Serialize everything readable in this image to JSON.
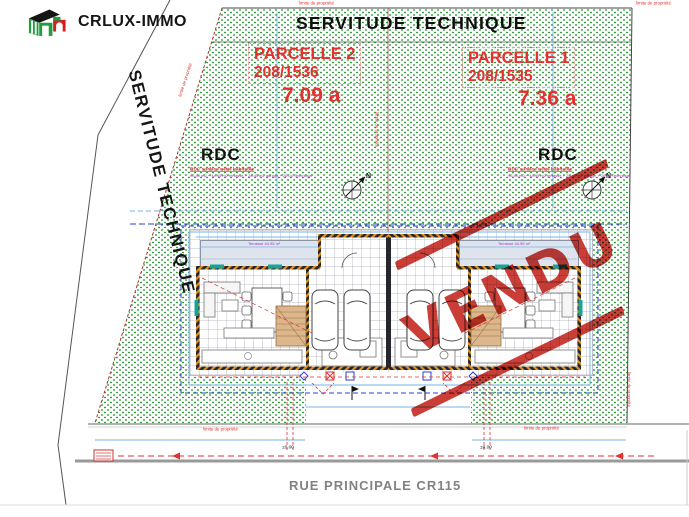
{
  "brand": {
    "name": "CRLUX-IMMO"
  },
  "plan": {
    "servitude_top": "SERVITUDE TECHNIQUE",
    "servitude_left": "SERVITUDE TECHNIQUE",
    "street_name": "RUE PRINCIPALE CR115",
    "boundary_label": "limite de propriété",
    "level_marker": "±0.00",
    "stamp_text": "VENDU",
    "north_letter": "N"
  },
  "parcels": [
    {
      "name": "PARCELLE 2",
      "lot_number": "208/1536",
      "area": "7.09 a",
      "floor_label": "RDC",
      "surface_title": "RDC surface nette habitable",
      "surface_detail": "95.40 m2 + 44.95 m2 terrasse + 28.45 m2 garage + 20.24 Technique",
      "terrace_label": "Terrasse 44.95 m²"
    },
    {
      "name": "PARCELLE 1",
      "lot_number": "208/1535",
      "area": "7.36 a",
      "floor_label": "RDC",
      "surface_title": "RDC surface nette habitable",
      "surface_detail": "95.40 m2 + 44.95 m2 terrasse + 28.45 m2 garage + 20.24 Technique",
      "terrace_label": "Terrasse 44.95 m²"
    }
  ],
  "colors": {
    "parcel_red": "#e53030",
    "stamp_red": "#c4231b",
    "hatch_green": "#2f9e3a",
    "dim_blue": "#7ab3e8",
    "setback_blue": "#2b3fd4",
    "street_gray": "#9a9a9a",
    "wall_dark": "#26262e",
    "wall_orange": "#e0901e",
    "surface_purple": "#a53ac0"
  }
}
